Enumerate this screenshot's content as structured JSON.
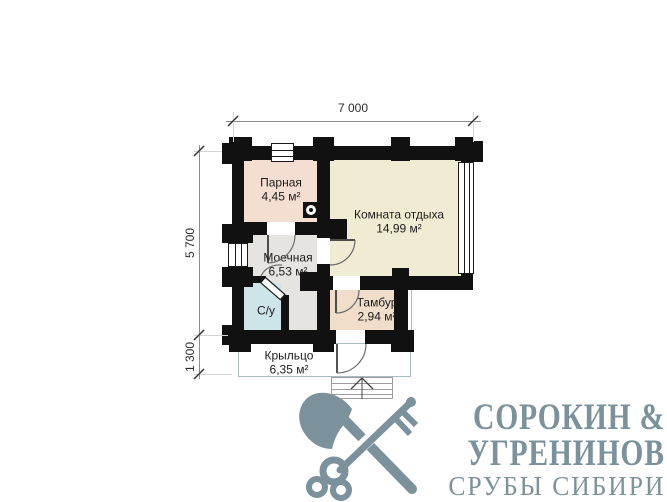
{
  "plan": {
    "dimensions": {
      "top_width": "7 000",
      "left_height": "5 700",
      "left_porch": "1 300"
    },
    "rooms": {
      "parnaya": {
        "name": "Парная",
        "area": "4,45 м²",
        "color": "#f4ded1"
      },
      "komnata_otdyha": {
        "name": "Комната отдыха",
        "area": "14,99 м²",
        "color": "#f0ecd4"
      },
      "moechnaya": {
        "name": "Моечная",
        "area": "6,53 м²",
        "color": "#e5e4e0"
      },
      "su": {
        "name": "С/у",
        "color": "#cde4e9"
      },
      "tambur": {
        "name": "Тамбур",
        "area": "2,94 м²",
        "color": "#f0ddca"
      },
      "krylco": {
        "name": "Крыльцо",
        "area": "6,35 м²",
        "color": "#ffffff"
      }
    },
    "wall_color": "#111111",
    "porch_outline_color": "#a6bdc2",
    "symbols": {
      "stove": "stove-icon",
      "entry_arrow": "entry-direction-arrow",
      "windows": "window-symbol",
      "doors": "door-swing-symbol"
    }
  },
  "logo": {
    "line1": "СОРОКИН &",
    "line2": "УГРЕНИНОВ",
    "line3": "СРУБЫ СИБИРИ",
    "color": "#7b919b",
    "icon": "crossed-axe-and-key-icon"
  }
}
